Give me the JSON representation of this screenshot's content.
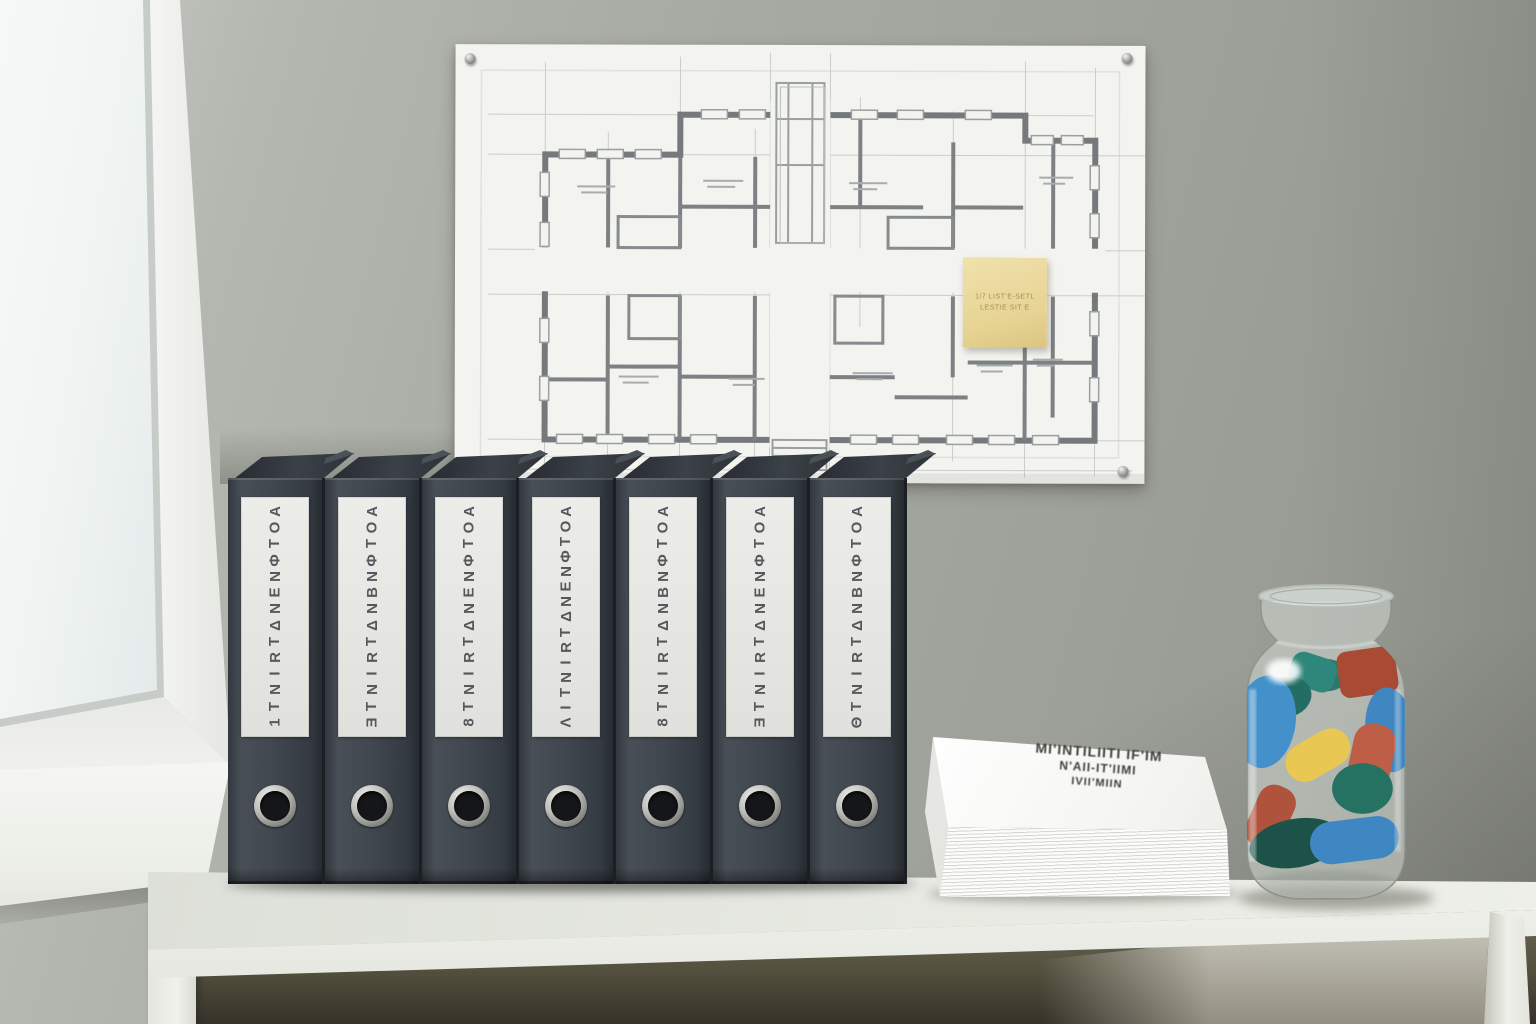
{
  "scene_title": "Office shelf with labeled binders, blueprint poster, paper stack and jar",
  "colors": {
    "wall": "#a8aba4",
    "window_glass": "#eef3f2",
    "window_frame": "#f6f7f4",
    "shelf_top": "#e7e9e2",
    "shelf_shadow": "#55513f",
    "binder_body": "#40474e",
    "binder_label": "#e6e6e2",
    "binder_label_text": "#55585c",
    "poster_paper": "#f3f3f0",
    "plan_wall_line": "#75797b",
    "plan_pencil_line": "#c3c7c5",
    "sticky_note": "#e7d494",
    "paper": "#fcfcfb",
    "jar_glass": "#d6dbd6",
    "piece_blue": "#3f8fcd",
    "piece_teal": "#2a8578",
    "piece_dark_teal": "#174f44",
    "piece_red": "#bf5b42",
    "piece_dark_red": "#a8462f",
    "piece_yellow": "#ebc94f"
  },
  "poster": {
    "pin_count": 4,
    "sticky_note": {
      "lines": [
        "1/7 LIST'E-SETL",
        "LESTIE SIT E"
      ]
    }
  },
  "binders": {
    "count": 7,
    "items": [
      {
        "label": "AOTΦNENΔTRINT1"
      },
      {
        "label": "AOTΦNBNΔTRINTƎ"
      },
      {
        "label": "AOTΦNENΔTRINT8"
      },
      {
        "label": "AOTΦNENΔTRINTIΛ"
      },
      {
        "label": "AOTΦNBNΔTRINT8"
      },
      {
        "label": "AOTΦNENΔTRINTƎ"
      },
      {
        "label": "AOTΦNBNΔTRINTΘ"
      }
    ]
  },
  "papers": {
    "stamp_lines": [
      "MI'INTILIITI IF'IM",
      "N'AII-IT'IIMI",
      "IVII'MIIN"
    ]
  },
  "jar": {
    "pieces": [
      {
        "type": "ellipse",
        "x": 100,
        "y": 96,
        "rx": 22,
        "ry": 16,
        "rot": 0,
        "fill": "#27766b"
      },
      {
        "type": "rect",
        "x": 64,
        "y": 76,
        "w": 46,
        "h": 34,
        "rot": 18,
        "r": 12,
        "fill": "#2a8578"
      },
      {
        "type": "rect",
        "x": 112,
        "y": 70,
        "w": 58,
        "h": 46,
        "rot": -8,
        "r": 10,
        "fill": "#a8462f"
      },
      {
        "type": "ellipse",
        "x": 60,
        "y": 118,
        "rx": 26,
        "ry": 20,
        "rot": -15,
        "fill": "#1e6b60"
      },
      {
        "type": "ellipse",
        "x": 40,
        "y": 142,
        "rx": 30,
        "ry": 46,
        "rot": 8,
        "fill": "#3f8fcd"
      },
      {
        "type": "ellipse",
        "x": 163,
        "y": 150,
        "rx": 24,
        "ry": 42,
        "rot": -6,
        "fill": "#3c86c2"
      },
      {
        "type": "ellipse",
        "x": 12,
        "y": 200,
        "rx": 9,
        "ry": 18,
        "rot": 0,
        "fill": "#d8a93f"
      },
      {
        "type": "rect",
        "x": 124,
        "y": 144,
        "w": 42,
        "h": 68,
        "rot": 12,
        "r": 18,
        "fill": "#bf5b42"
      },
      {
        "type": "rect",
        "x": 58,
        "y": 156,
        "w": 68,
        "h": 38,
        "rot": -30,
        "r": 19,
        "fill": "#ebc94f"
      },
      {
        "type": "rect",
        "x": 26,
        "y": 204,
        "w": 38,
        "h": 64,
        "rot": 24,
        "r": 16,
        "fill": "#b04f38"
      },
      {
        "type": "ellipse",
        "x": 136,
        "y": 208,
        "rx": 30,
        "ry": 25,
        "rot": 0,
        "fill": "#20705f"
      },
      {
        "type": "ellipse",
        "x": 70,
        "y": 262,
        "rx": 46,
        "ry": 24,
        "rot": -10,
        "fill": "#174f44"
      },
      {
        "type": "rect",
        "x": 84,
        "y": 238,
        "w": 88,
        "h": 42,
        "rot": -7,
        "r": 21,
        "fill": "#3b86c4"
      }
    ]
  }
}
